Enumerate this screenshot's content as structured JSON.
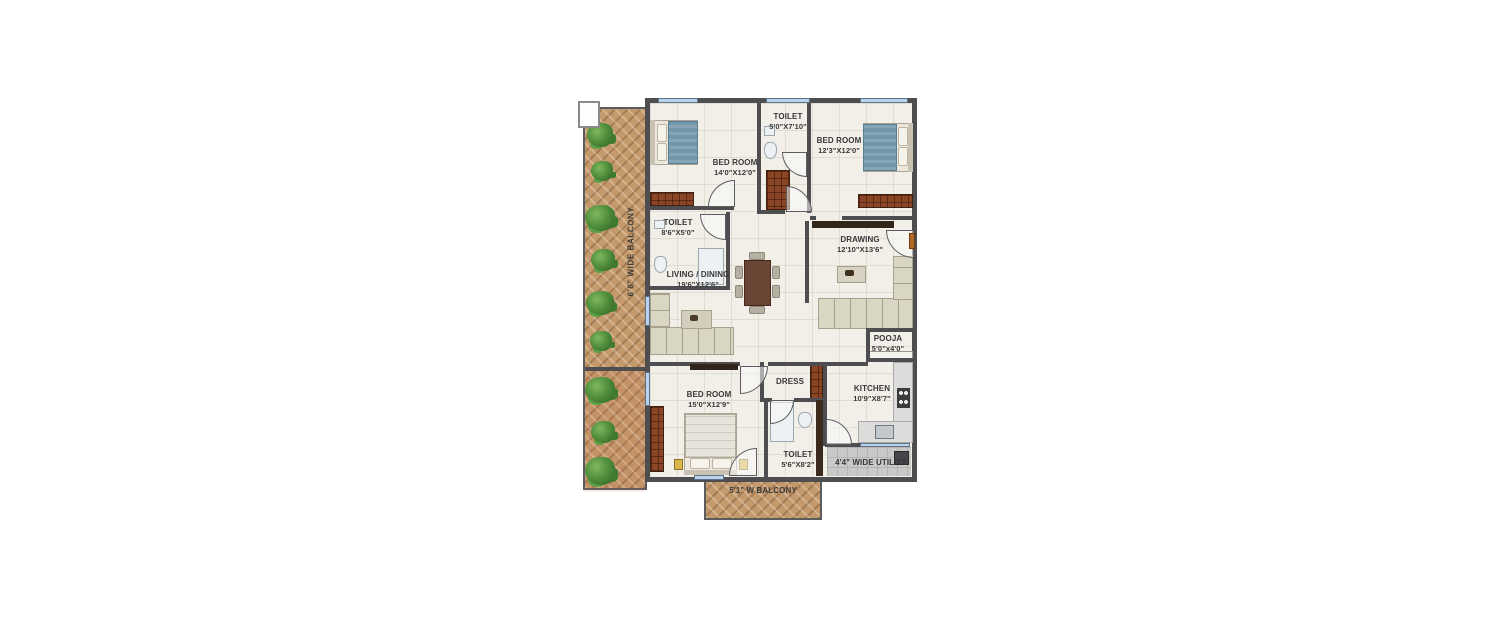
{
  "plan": {
    "rooms": {
      "balcony_left": {
        "label": "6'6\" WIDE BALCONY"
      },
      "bed1": {
        "label": "BED ROOM",
        "dims": "14'0\"X12'0\""
      },
      "toilet_top": {
        "label": "TOILET",
        "dims": "5'0\"X7'10\""
      },
      "bed2": {
        "label": "BED ROOM",
        "dims": "12'3\"X12'0\""
      },
      "toilet_mid": {
        "label": "TOILET",
        "dims": "8'6\"X5'0\""
      },
      "living": {
        "label": "LIVING / DINING",
        "dims": "19'6\"X12'6\""
      },
      "drawing": {
        "label": "DRAWING",
        "dims": "12'10\"X13'6\""
      },
      "pooja": {
        "label": "POOJA",
        "dims": "5'0\"x4'0\""
      },
      "dress": {
        "label": "DRESS"
      },
      "kitchen": {
        "label": "KITCHEN",
        "dims": "10'9\"X8'7\""
      },
      "bed3": {
        "label": "BED ROOM",
        "dims": "15'0\"X12'9\""
      },
      "toilet_bottom": {
        "label": "TOILET",
        "dims": "5'6\"X8'2\""
      },
      "utility": {
        "label": "4'4\" WIDE UTILITY"
      },
      "balcony_bottom": {
        "label": "5'1\" W BALCONY"
      }
    },
    "colors": {
      "wall": "#4e4e50",
      "wood": "#c49a6c",
      "window_glass": "#b9d3ec",
      "plant_green": "#4e8c3b",
      "bed_teal": "#7296aa",
      "floor_tile": "#f2efe8",
      "wardrobe_brown": "#8a4526"
    }
  }
}
